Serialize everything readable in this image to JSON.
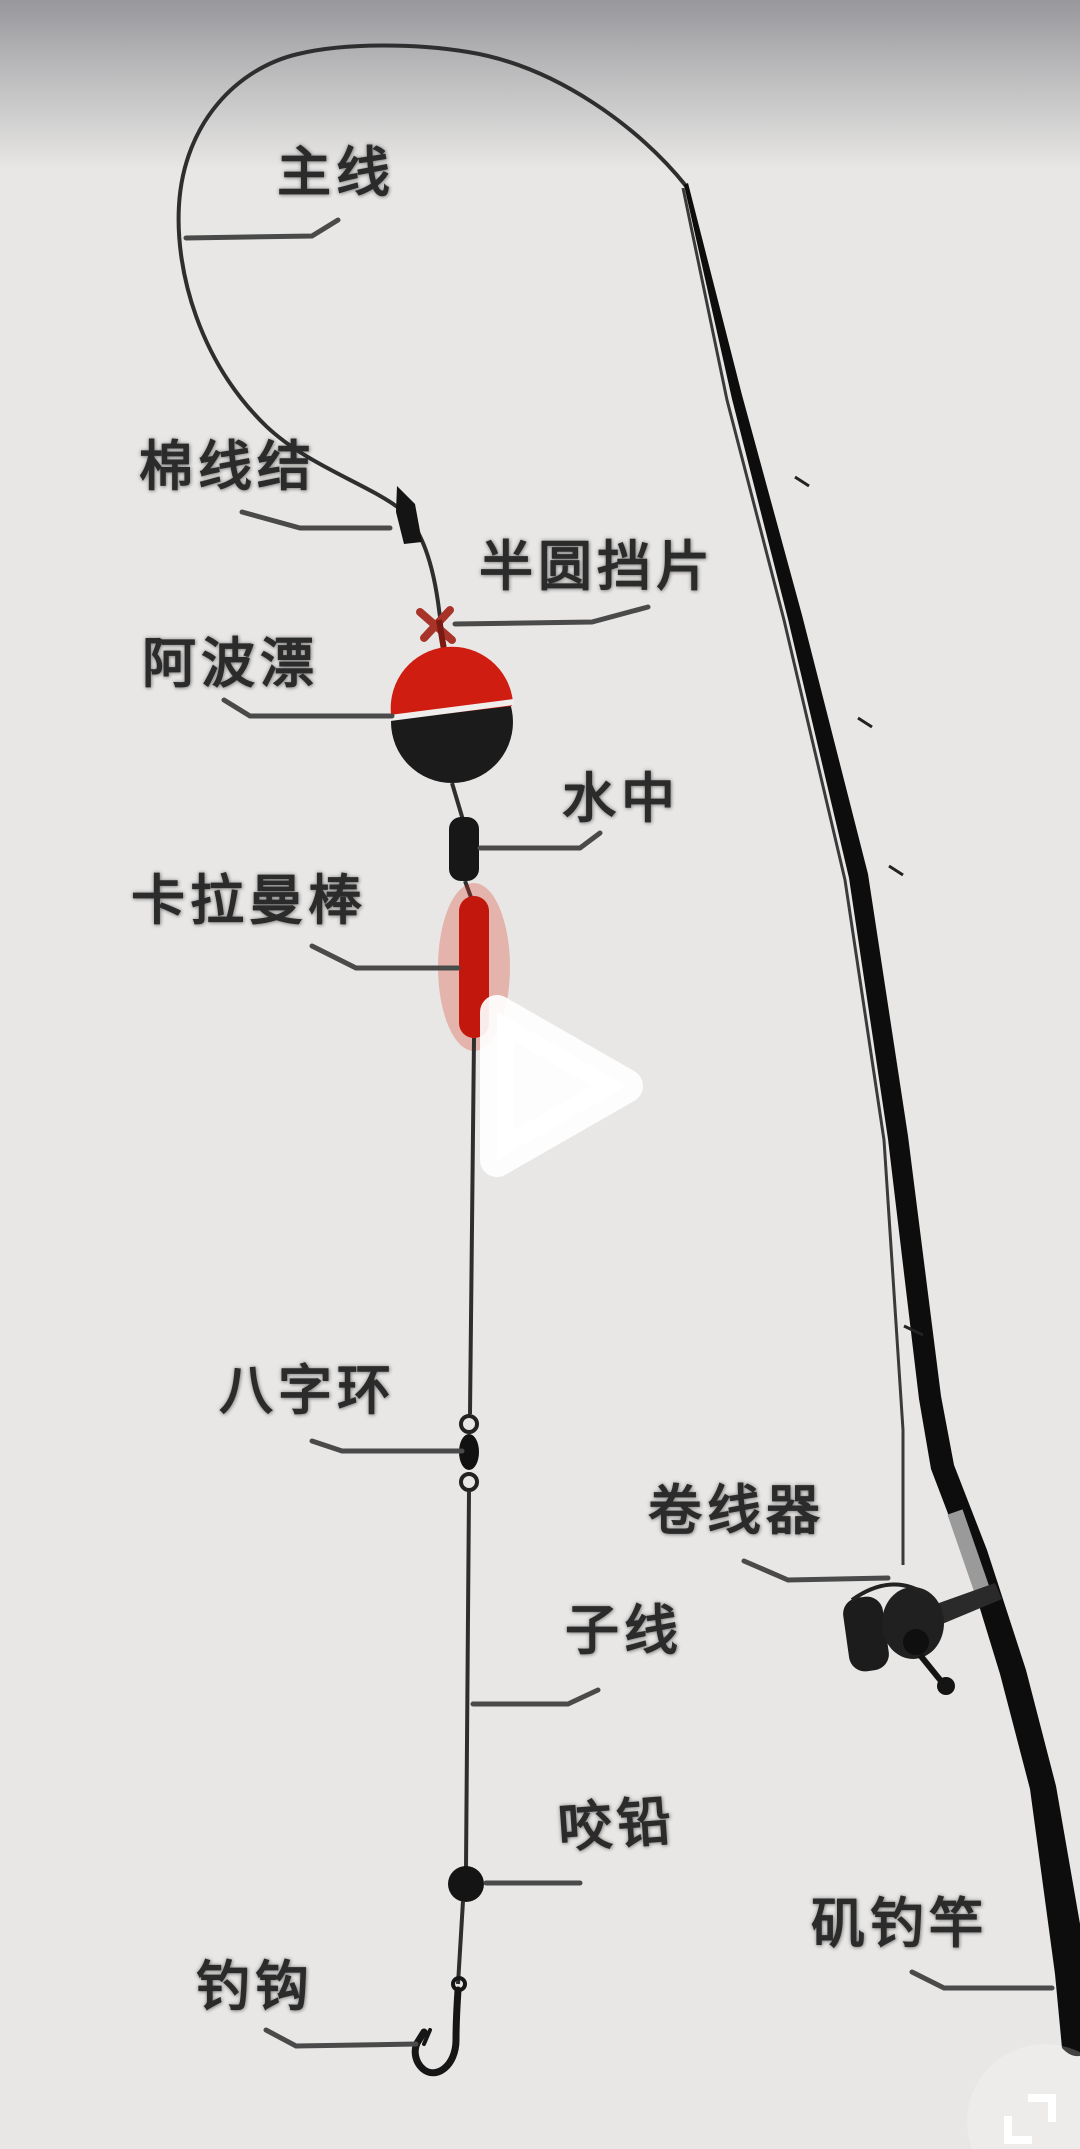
{
  "diagram": {
    "labels": {
      "main_line": "主线",
      "cotton_knot": "棉线结",
      "semicircle_stopper": "半圆挡片",
      "apollo_float": "阿波漂",
      "water_sinker": "水中",
      "karaman_stick": "卡拉曼棒",
      "figure_eight_swivel": "八字环",
      "reel": "卷线器",
      "sub_line": "子线",
      "bite_lead": "咬铅",
      "rock_fishing_rod": "矶钓竿",
      "fish_hook": "钓钩"
    }
  },
  "player": {
    "play_icon": "play-triangle",
    "fullscreen_icon": "fullscreen-corners"
  },
  "colors": {
    "background": "#e8e7e5",
    "top_fade": "#97979c",
    "label_text": "#2b2b2b",
    "leader_line": "#4a4a4a",
    "fishing_line": "#2e2e2e",
    "rod_black": "#0d0d0d",
    "float_red": "#cf1d12",
    "float_black": "#1b1b1b",
    "stick_red": "#c2170c",
    "stick_glow": "rgba(215,45,25,0.28)",
    "stopper_red": "#a83328",
    "overlay_white": "#ffffff"
  }
}
